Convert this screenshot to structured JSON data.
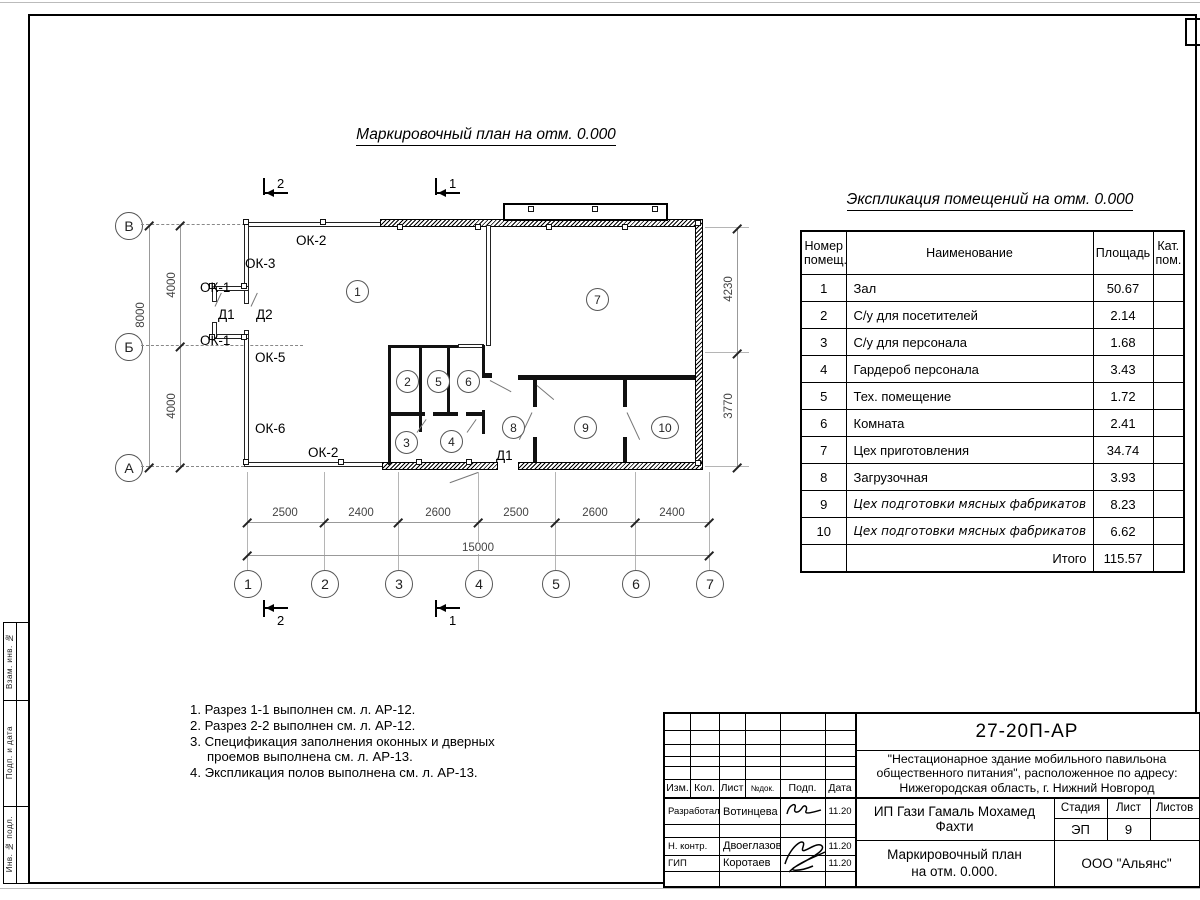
{
  "plan": {
    "title": "Маркировочный план на отм. 0.000",
    "rooms": [
      "1",
      "2",
      "3",
      "4",
      "5",
      "6",
      "7",
      "8",
      "9",
      "10"
    ],
    "axes_letters": [
      "В",
      "Б",
      "А"
    ],
    "axes_numbers": [
      "1",
      "2",
      "3",
      "4",
      "5",
      "6",
      "7"
    ],
    "dims_bottom": [
      "2500",
      "2400",
      "2600",
      "2500",
      "2600",
      "2400"
    ],
    "dim_bottom_total": "15000",
    "dims_left": [
      "4000",
      "4000"
    ],
    "dim_left_total": "8000",
    "dims_right": [
      "4230",
      "3770"
    ],
    "sections": {
      "s1": "1",
      "s2": "2"
    },
    "openings": {
      "ok1": "ОК-1",
      "ok2": "ОК-2",
      "ok3": "ОК-3",
      "ok5": "ОК-5",
      "ok6": "ОК-6",
      "d1": "Д1",
      "d2": "Д2"
    }
  },
  "schedule": {
    "title": "Экспликация помещений на отм. 0.000",
    "headers": {
      "num": "Номер помещ.",
      "name": "Наименование",
      "area": "Площадь",
      "cat": "Кат. пом."
    },
    "rows": [
      {
        "num": "1",
        "name": "Зал",
        "area": "50.67"
      },
      {
        "num": "2",
        "name": "С/у для посетителей",
        "area": "2.14"
      },
      {
        "num": "3",
        "name": "С/у для персонала",
        "area": "1.68"
      },
      {
        "num": "4",
        "name": "Гардероб персонала",
        "area": "3.43"
      },
      {
        "num": "5",
        "name": "Тех. помещение",
        "area": "1.72"
      },
      {
        "num": "6",
        "name": "Комната",
        "area": "2.41"
      },
      {
        "num": "7",
        "name": "Цех приготовления",
        "area": "34.74"
      },
      {
        "num": "8",
        "name": "Загрузочная",
        "area": "3.93"
      },
      {
        "num": "9",
        "name": "Цех подготовки мясных фабрикатов",
        "area": "8.23"
      },
      {
        "num": "10",
        "name": "Цех подготовки мясных фабрикатов",
        "area": "6.62"
      }
    ],
    "total_label": "Итого",
    "total_value": "115.57"
  },
  "notes": [
    "1. Разрез 1-1 выполнен см. л. АР-12.",
    "2. Разрез 2-2 выполнен см. л. АР-12.",
    "3. Спецификация заполнения оконных и дверных проемов выполнена см. л. АР-13.",
    "4. Экспликация полов выполнена см. л. АР-13."
  ],
  "titleblock": {
    "doc_number": "27-20П-АР",
    "project": "\"Нестационарное здание мобильного павильона общественного питания\", расположенное по адресу: Нижегородская область, г. Нижний Новгород",
    "client": "ИП Гази Гамаль Мохамед Фахти",
    "sheet_title_1": "Маркировочный план",
    "sheet_title_2": "на отм. 0.000.",
    "company": "ООО \"Альянс\"",
    "stage_label": "Стадия",
    "stage_value": "ЭП",
    "sheet_label": "Лист",
    "sheet_value": "9",
    "sheets_label": "Листов",
    "sheets_value": "",
    "columns": [
      "Изм.",
      "Кол.",
      "Лист",
      "№док.",
      "Подп.",
      "Дата"
    ],
    "signers": [
      {
        "role": "Разработал",
        "name": "Вотинцева",
        "date": "11.20"
      },
      {
        "role": "Н. контр.",
        "name": "Двоеглазов",
        "date": "11.20"
      },
      {
        "role": "ГИП",
        "name": "Коротаев",
        "date": "11.20"
      }
    ]
  },
  "side_stamp": [
    "Взам. инв. №",
    "Подп. и дата",
    "Инв. № подл."
  ]
}
